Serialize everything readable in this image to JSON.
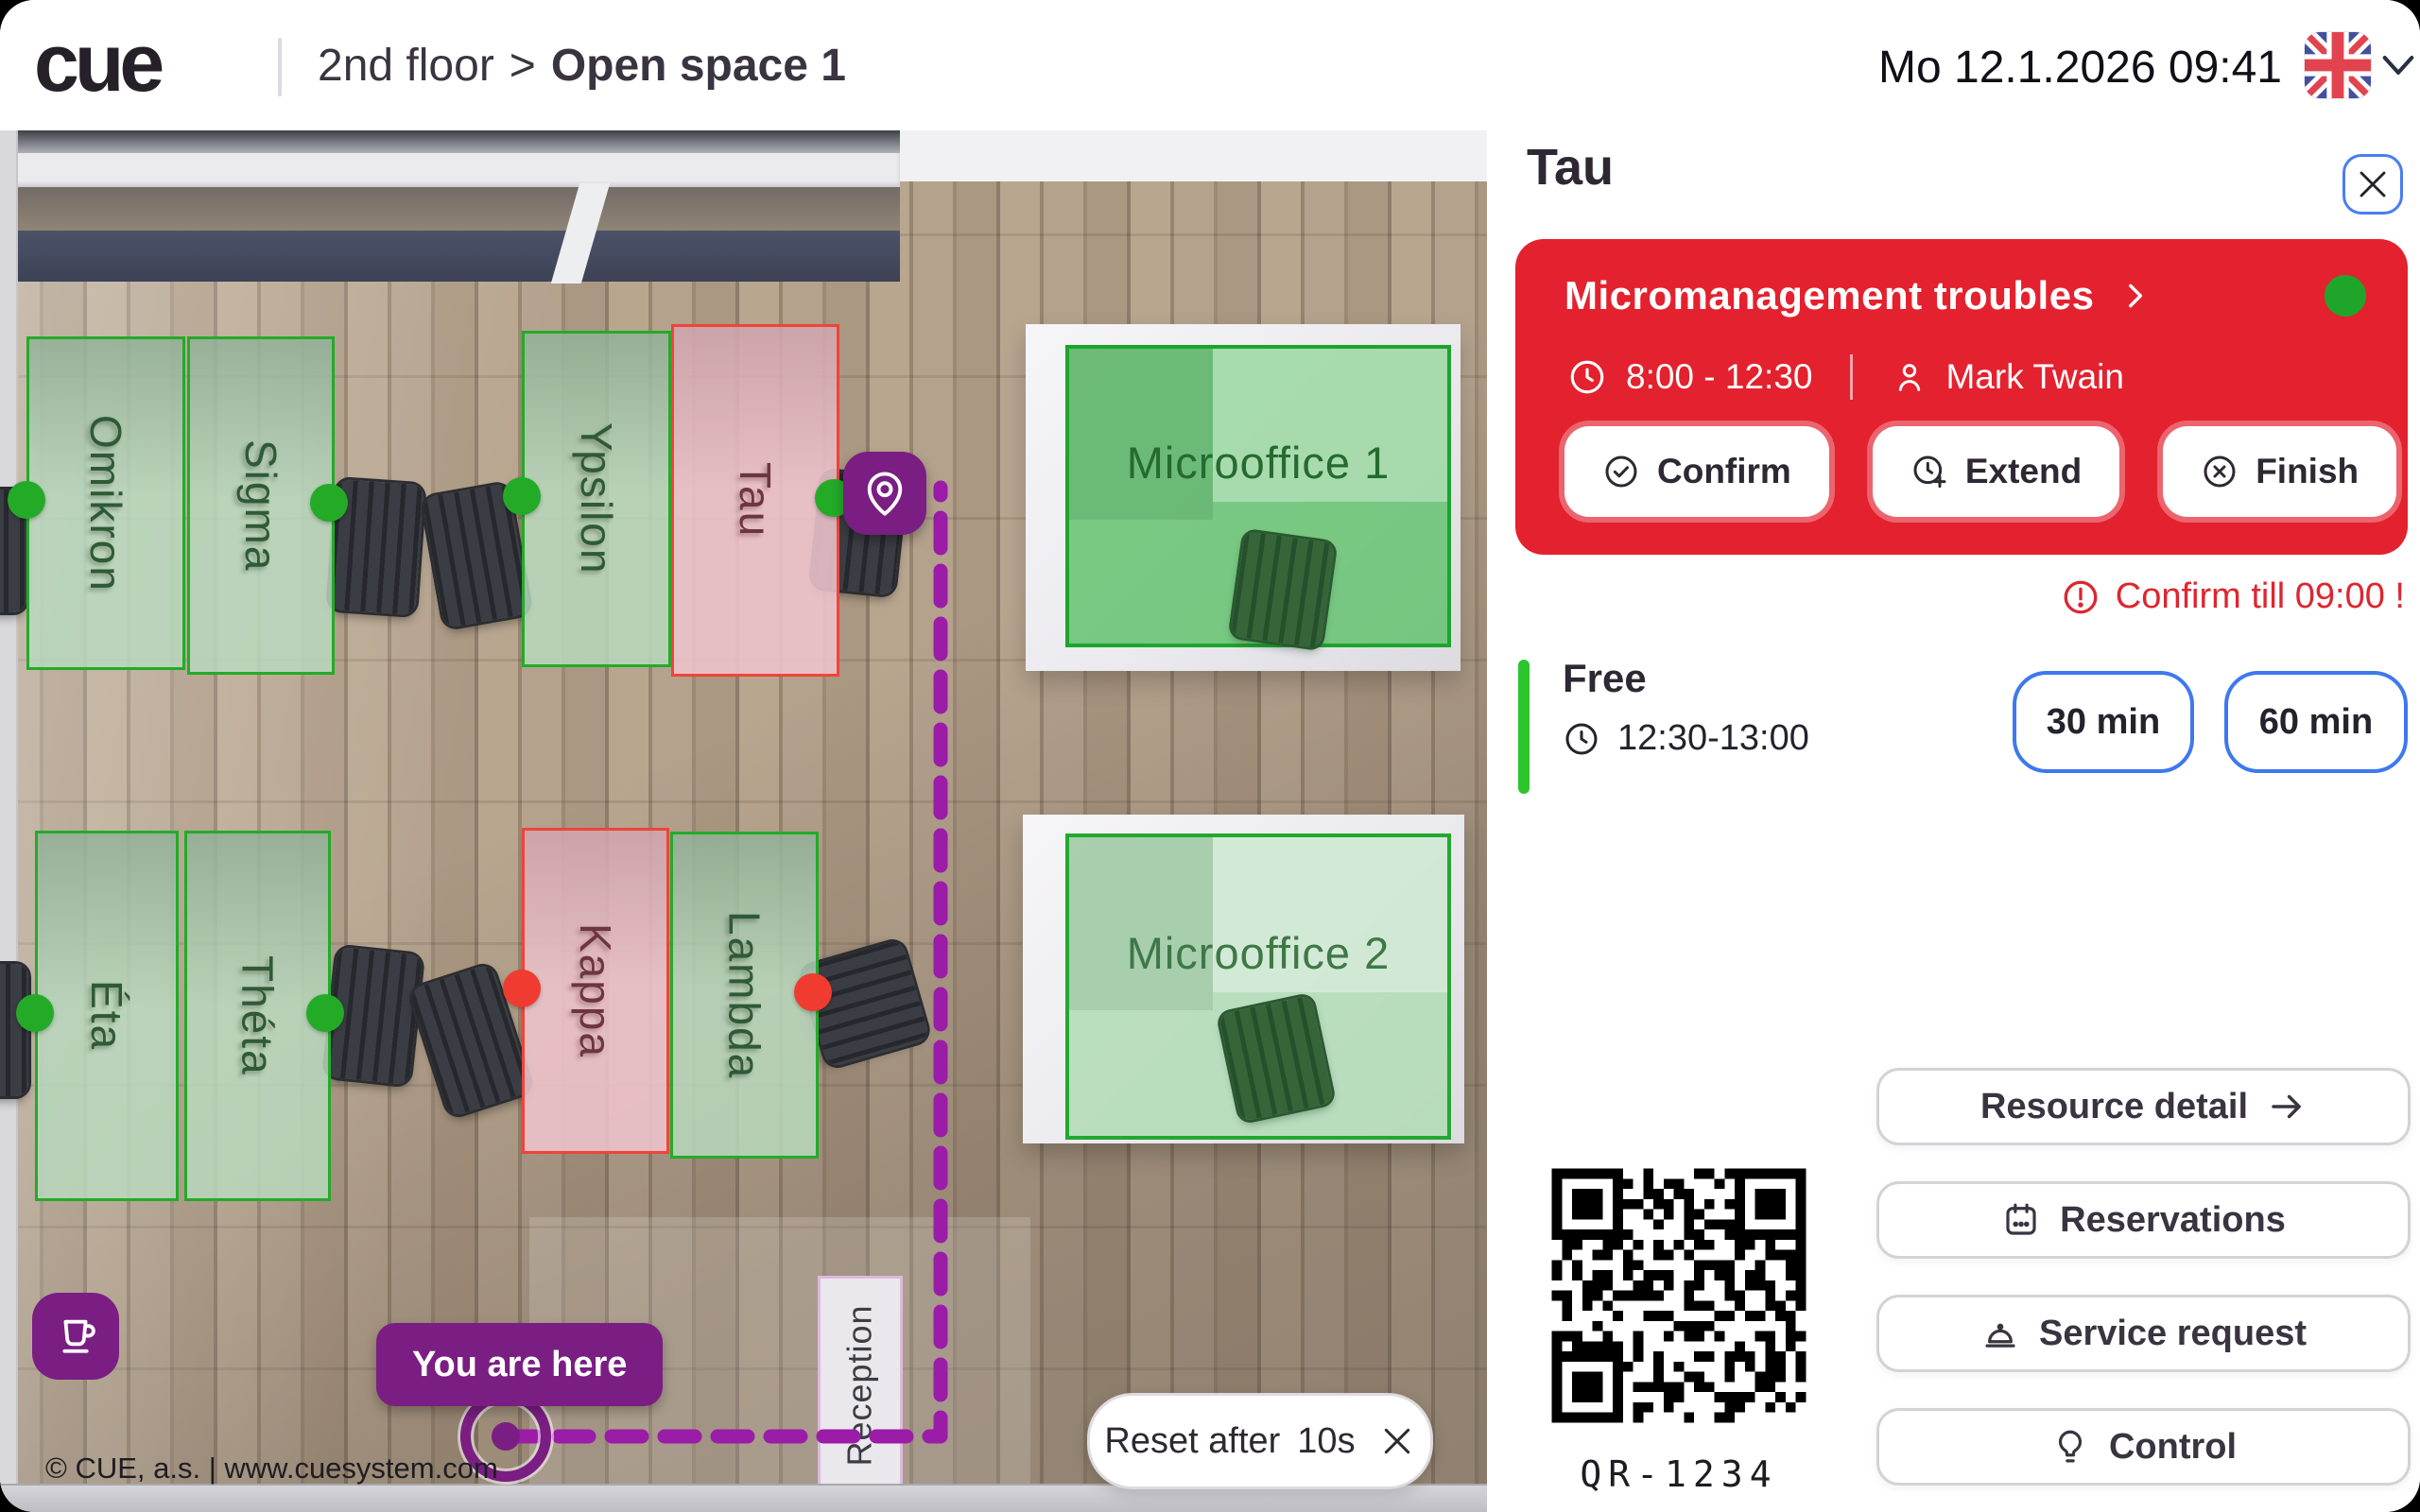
{
  "topbar": {
    "logo": "cue",
    "breadcrumb": {
      "floor": "2nd floor",
      "separator": ">",
      "room": "Open space 1"
    },
    "datetime": "Mo 12.1.2026 09:41",
    "language_flag": "uk-flag-icon"
  },
  "colors": {
    "accent_purple": "#7A1E83",
    "dash_purple": "#9B1CA6",
    "reservation_red": "#E4212E",
    "status_free": "#23AB28",
    "status_busy": "#F03B30",
    "status_busy_border": "#F04438",
    "action_blue": "#3E78F0"
  },
  "map": {
    "desks": [
      {
        "label": "Omikron",
        "desk_status": "free",
        "sensor": "free"
      },
      {
        "label": "Sigma",
        "desk_status": "free",
        "sensor": "free"
      },
      {
        "label": "Ypsilon",
        "desk_status": "free",
        "sensor": "free"
      },
      {
        "label": "Tau",
        "desk_status": "busy",
        "sensor": "free"
      },
      {
        "label": "Éta",
        "desk_status": "free",
        "sensor": "free"
      },
      {
        "label": "Théta",
        "desk_status": "free",
        "sensor": "free"
      },
      {
        "label": "Kappa",
        "desk_status": "busy",
        "sensor": "busy"
      },
      {
        "label": "Lambda",
        "desk_status": "free",
        "sensor": "busy"
      }
    ],
    "rooms": [
      {
        "label": "Microoffice 1"
      },
      {
        "label": "Microoffice 2"
      }
    ],
    "reception": "Reception",
    "you_are_here": "You are here",
    "reset": {
      "label": "Reset after",
      "countdown": "10s"
    },
    "copyright": "© CUE, a.s. | www.cuesystem.com"
  },
  "panel": {
    "title": "Tau",
    "reservation": {
      "title": "Micromanagement troubles",
      "time": "8:00 - 12:30",
      "organizer": "Mark Twain",
      "confirm": "Confirm",
      "extend": "Extend",
      "finish": "Finish"
    },
    "warning": "Confirm till 09:00 !",
    "next": {
      "status": "Free",
      "time": "12:30-13:00",
      "extend30": "30 min",
      "extend60": "60 min"
    },
    "qr": "QR-1234",
    "actions": {
      "resource": "Resource detail",
      "reservations": "Reservations",
      "service": "Service request",
      "control": "Control"
    }
  }
}
